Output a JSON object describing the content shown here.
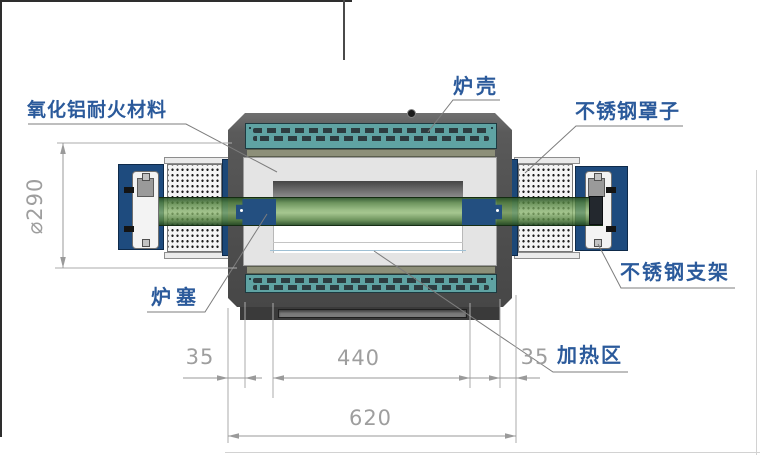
{
  "labels": {
    "refractory": "氧化铝耐火材料",
    "shell": "炉壳",
    "steel_cover": "不锈钢罩子",
    "steel_bracket": "不锈钢支架",
    "plug": "炉塞",
    "heating_zone": "加热区"
  },
  "dimensions": {
    "diameter": "⌀290",
    "left_end": "35",
    "heating_length": "440",
    "right_end": "35",
    "total_length": "620"
  },
  "colors": {
    "label_blue": "#2b5a9b",
    "dimension_gray": "#9e9e9e",
    "leader_gray": "#7d7d7d",
    "shell_gray": "#555555",
    "vent_teal": "#5fa3a3",
    "slot_dark": "#2d3c40",
    "insulation_olive": "#8d8f79",
    "refractory_gray": "#e4e4e4",
    "stand_navy": "#1e4b7e",
    "tube_green": "#79ab63",
    "cover_white": "#f4f4f4"
  }
}
